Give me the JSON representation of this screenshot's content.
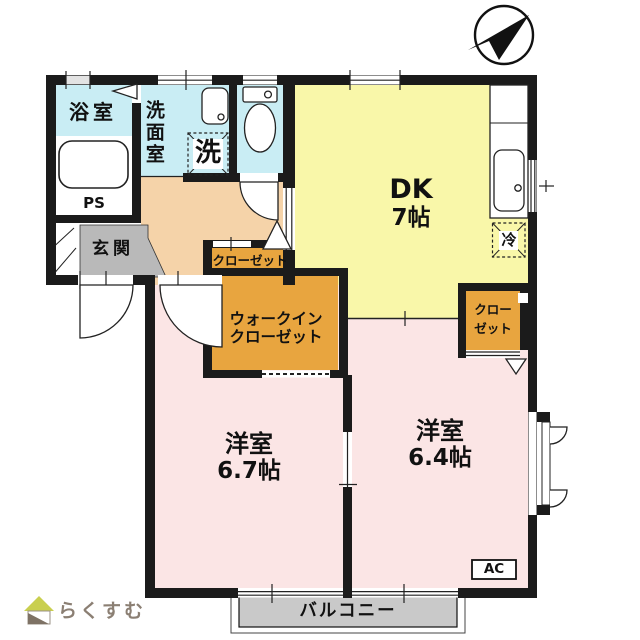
{
  "plan": {
    "bathroom": "浴室",
    "washroom": "洗面室",
    "washing_machine": "洗",
    "pipe_space": "PS",
    "entrance": "玄関",
    "dk_name": "DK",
    "dk_size": "7帖",
    "hall_closet": "クローゼット",
    "wic_line1": "ウォークイン",
    "wic_line2": "クローゼット",
    "bedroom1_name": "洋室",
    "bedroom1_size": "6.7帖",
    "bedroom2_name": "洋室",
    "bedroom2_size": "6.4帖",
    "right_closet_line1": "クロー",
    "right_closet_line2": "ゼット",
    "refrigerator": "冷",
    "ac_unit": "AC",
    "balcony": "バルコニー"
  },
  "watermark": {
    "text": "らくすむ"
  },
  "colors": {
    "wet_area": "#c9edf4",
    "hallway": "#f5d3a9",
    "dk": "#f9f7a9",
    "bedroom": "#fbe5e5",
    "closet": "#e8a53f",
    "entrance_floor": "#b9b9b9",
    "balcony_floor": "#c9c9c9",
    "wall": "#1b1b1b",
    "logo_text": "#8b7f73",
    "logo_roof": "#c9cf4f"
  }
}
